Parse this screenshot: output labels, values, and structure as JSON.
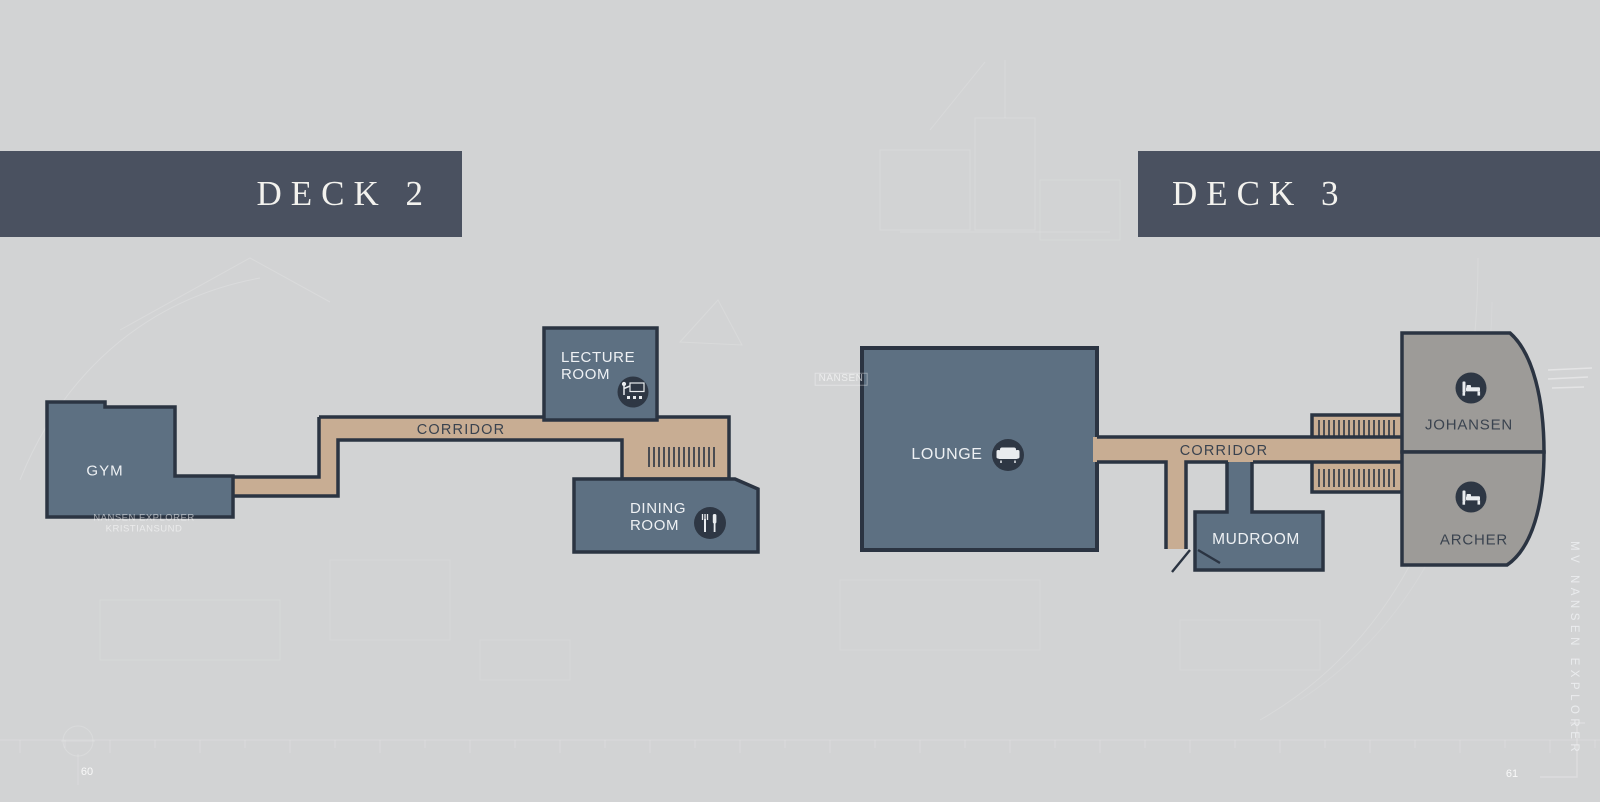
{
  "page": {
    "left_page_number": "60",
    "right_page_number": "61",
    "side_caption": "MV NANSEN EXPLORER"
  },
  "deck2": {
    "title": "DECK 2",
    "rooms": {
      "gym": {
        "label": "GYM"
      },
      "corridor": {
        "label": "CORRIDOR"
      },
      "lecture_room": {
        "line1": "LECTURE",
        "line2": "ROOM",
        "icon": "presentation-icon"
      },
      "dining_room": {
        "line1": "DINING",
        "line2": "ROOM",
        "icon": "cutlery-icon"
      }
    }
  },
  "deck3": {
    "title": "DECK 3",
    "rooms": {
      "lounge": {
        "label": "LOUNGE",
        "icon": "sofa-icon"
      },
      "corridor": {
        "label": "CORRIDOR"
      },
      "mudroom": {
        "label": "MUDROOM"
      },
      "johansen": {
        "label": "JOHANSEN",
        "icon": "bed-icon"
      },
      "archer": {
        "label": "ARCHER",
        "icon": "bed-icon"
      }
    }
  },
  "watermarks": {
    "builder_line1": "NANSEN EXPLORER",
    "builder_line2": "KRISTIANSUND",
    "hull_label": "NANSEN"
  },
  "colors": {
    "background": "#d2d3d4",
    "header_bar": "#4a5160",
    "room_fill": "#5d7082",
    "cabin_fill": "#9d9b98",
    "corridor_fill": "#c8ad93",
    "wall": "#2b3442",
    "icon_circle": "#2e3744",
    "label_light": "#eef1f4",
    "label_dark": "#3a434f"
  }
}
